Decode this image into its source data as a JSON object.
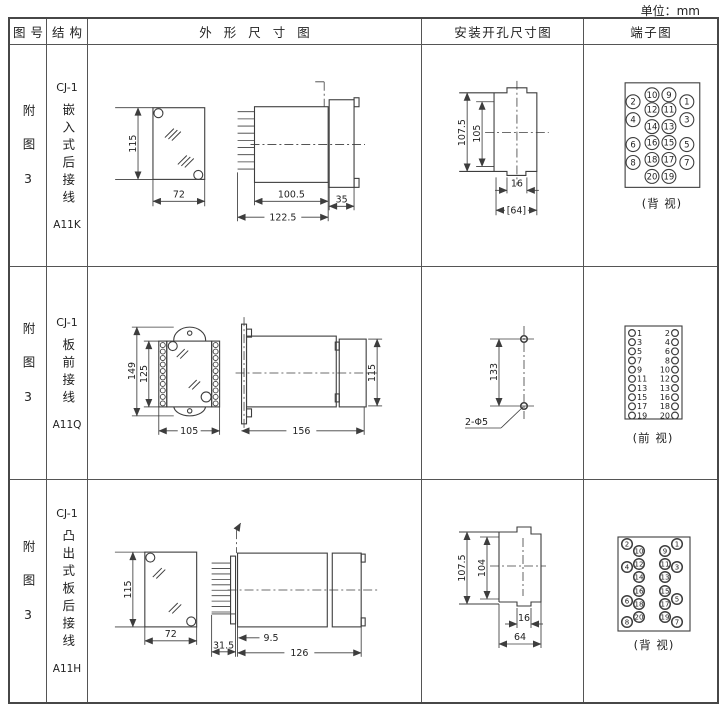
{
  "unit_label": "单位：mm",
  "header": {
    "col_fig": "图号",
    "col_structure": "结构",
    "col_outline": "外形尺寸图",
    "col_install": "安装开孔尺寸图",
    "col_terminal": "端子图"
  },
  "rows": [
    {
      "fig_no": "附图3",
      "structure": {
        "model": "CJ-1",
        "name": "嵌入式后接线",
        "code": "A11K"
      },
      "outline": {
        "height": "115",
        "width": "72",
        "body_len": "100.5",
        "flange_len": "35",
        "total_len": "122.5"
      },
      "install": {
        "outer_h": "107.5",
        "inner_h": "105",
        "slot_w": "16",
        "open_w": "[64]"
      },
      "terminal": {
        "view_label": "(背 视)",
        "outer_left": [
          "2",
          "4",
          "6",
          "8"
        ],
        "mid_left": [
          "10",
          "12",
          "14",
          "16",
          "18",
          "20"
        ],
        "mid_right": [
          "9",
          "11",
          "13",
          "15",
          "17",
          "19"
        ],
        "outer_right": [
          "1",
          "3",
          "5",
          "7"
        ]
      }
    },
    {
      "fig_no": "附图3",
      "structure": {
        "model": "CJ-1",
        "name": "板前接线",
        "code": "A11Q"
      },
      "outline": {
        "outer_h": "149",
        "inner_h": "125",
        "width": "105",
        "body_len": "156",
        "rear_h": "115"
      },
      "install": {
        "hole_dist": "133",
        "hole_note": "2-Φ5"
      },
      "terminal": {
        "view_label": "(前 视)",
        "left": [
          "1",
          "3",
          "5",
          "7",
          "9",
          "11",
          "13",
          "15",
          "17",
          "19"
        ],
        "right": [
          "2",
          "4",
          "6",
          "8",
          "10",
          "12",
          "13",
          "16",
          "18",
          "20"
        ]
      }
    },
    {
      "fig_no": "附图3",
      "structure": {
        "model": "CJ-1",
        "name": "凸出式板后接线",
        "code": "A11H"
      },
      "outline": {
        "height": "115",
        "width": "72",
        "pin_len": "31.5",
        "gap": "9.5",
        "body_len": "126"
      },
      "install": {
        "outer_h": "107.5",
        "inner_h": "104",
        "slot_w": "16",
        "open_w": "64"
      },
      "terminal": {
        "view_label": "(背 视)",
        "outer_left": [
          "2",
          "4",
          "6",
          "8"
        ],
        "mid_left": [
          "10",
          "12",
          "14",
          "16",
          "18",
          "20"
        ],
        "mid_right": [
          "9",
          "11",
          "13",
          "15",
          "17",
          "19"
        ],
        "outer_right": [
          "1",
          "3",
          "5",
          "7"
        ]
      }
    }
  ]
}
